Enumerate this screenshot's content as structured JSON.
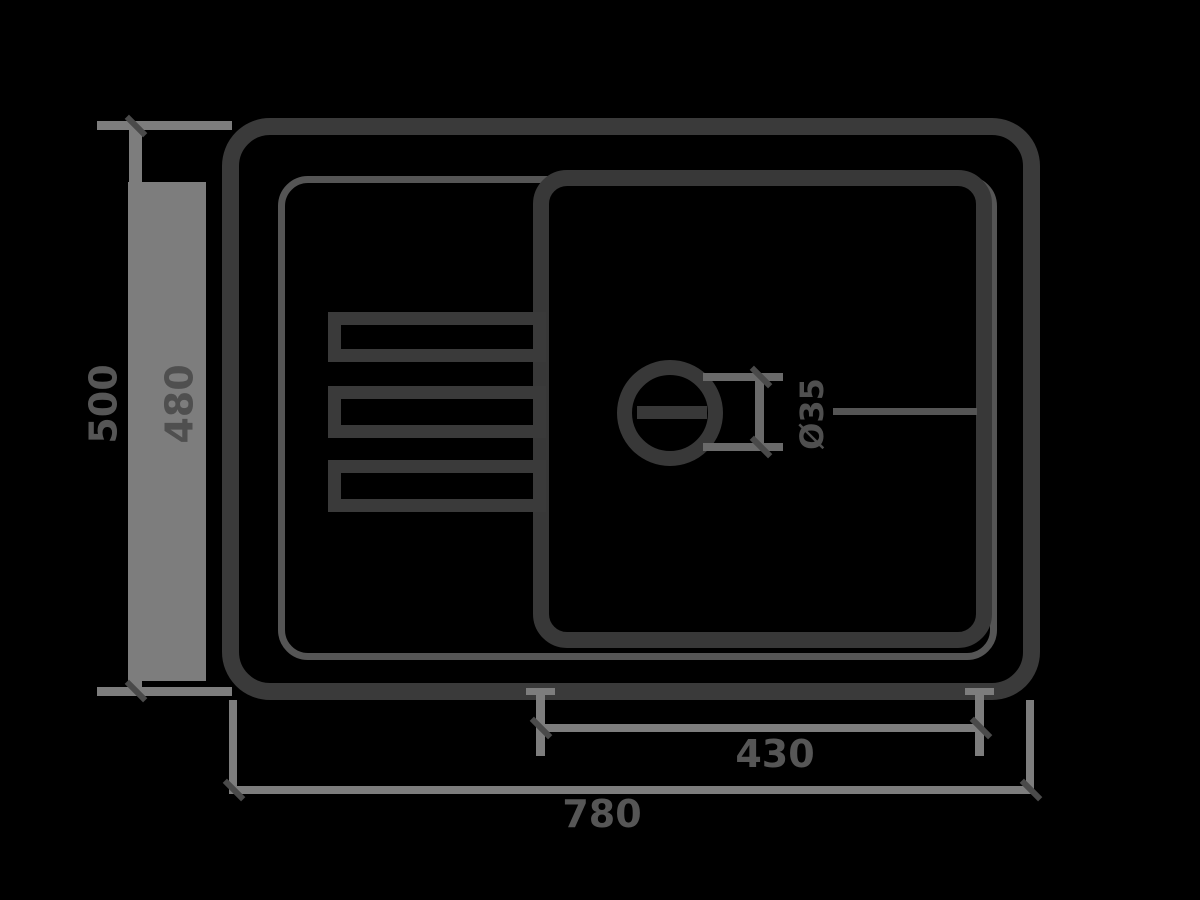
{
  "colors": {
    "background": "#000000",
    "sink_outline": "#3a3a3a",
    "rim_outline": "#555555",
    "dimension_line": "#7d7d7d",
    "label_text": "#5a5a5a"
  },
  "dims": {
    "depth_overall": "500",
    "depth_cutout": "480",
    "basin_width": "430",
    "width_overall": "780",
    "drain_diameter": "Ø35"
  }
}
